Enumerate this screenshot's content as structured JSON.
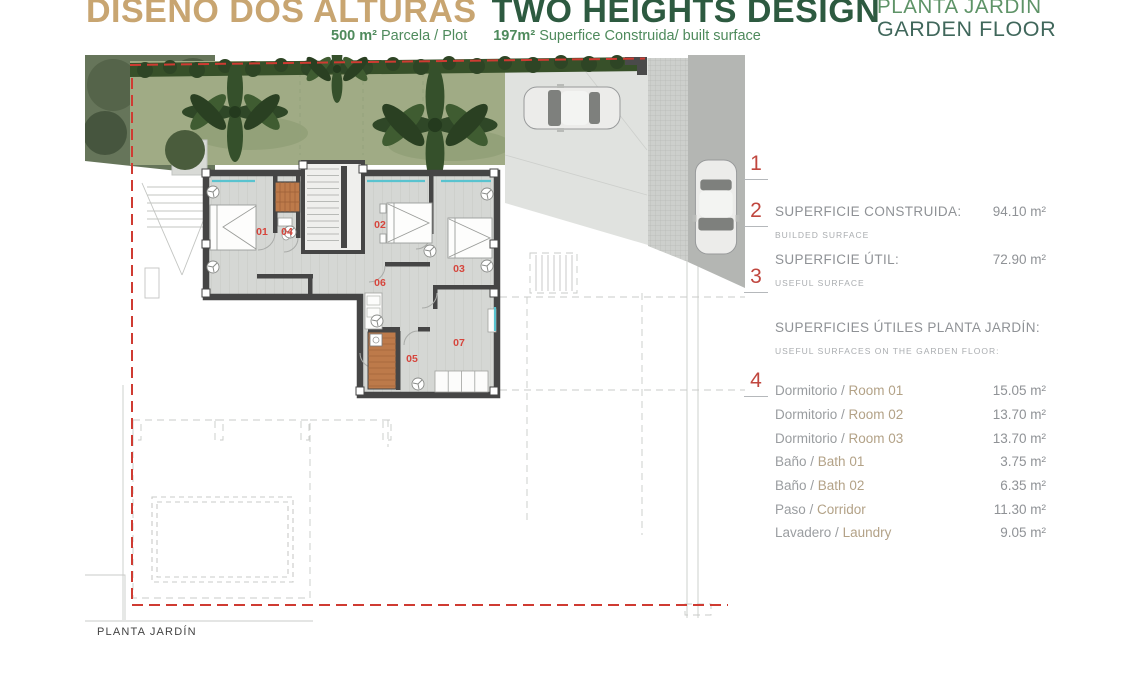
{
  "header": {
    "title_es": "DISEÑO DOS ALTURAS",
    "title_en": "TWO HEIGHTS DESIGN",
    "plot_value": "500 m²",
    "plot_label": "Parcela / Plot",
    "built_value": "197m²",
    "built_label": "Superfice Construida/ built surface"
  },
  "floor_title": {
    "line1": "PLANTA JARDIN",
    "line2": "GARDEN FLOOR"
  },
  "plan": {
    "caption": "PLANTA JARDÍN",
    "room_numbers": [
      "01",
      "02",
      "03",
      "04",
      "05",
      "06",
      "07"
    ],
    "markers": [
      "1",
      "2",
      "3",
      "4"
    ]
  },
  "panel": {
    "sep": " / ",
    "built": {
      "label": "SUPERFICIE CONSTRUIDA:",
      "sublabel": "BUILDED SURFACE",
      "value": "94.10 m²"
    },
    "useful": {
      "label": "SUPERFICIE ÚTIL:",
      "sublabel": "USEFUL SURFACE",
      "value": "72.90 m²"
    },
    "section": {
      "label": "SUPERFICIES ÚTILES PLANTA JARDÍN:",
      "sublabel": "USEFUL SURFACES ON THE GARDEN FLOOR:"
    },
    "rooms": [
      {
        "es": "Dormitorio",
        "en": "Room 01",
        "value": "15.05 m²"
      },
      {
        "es": "Dormitorio",
        "en": "Room 02",
        "value": "13.70 m²"
      },
      {
        "es": "Dormitorio",
        "en": "Room 03",
        "value": "13.70 m²"
      },
      {
        "es": "Baño",
        "en": "Bath 01",
        "value": "3.75 m²"
      },
      {
        "es": "Baño",
        "en": "Bath 02",
        "value": "6.35 m²"
      },
      {
        "es": "Paso",
        "en": "Corridor",
        "value": "11.30 m²"
      },
      {
        "es": "Lavadero",
        "en": "Laundry",
        "value": "9.05 m²"
      }
    ]
  },
  "colors": {
    "accent_tan": "#c8a571",
    "green_dark": "#2d5a40",
    "green_mid": "#4e8a5c",
    "red_boundary": "#cf3b32",
    "red_label": "#d6453c",
    "wall": "#454545",
    "window_teal": "#59c3cf",
    "wood": "#bd7a4a",
    "grass": "#a0ab85"
  }
}
